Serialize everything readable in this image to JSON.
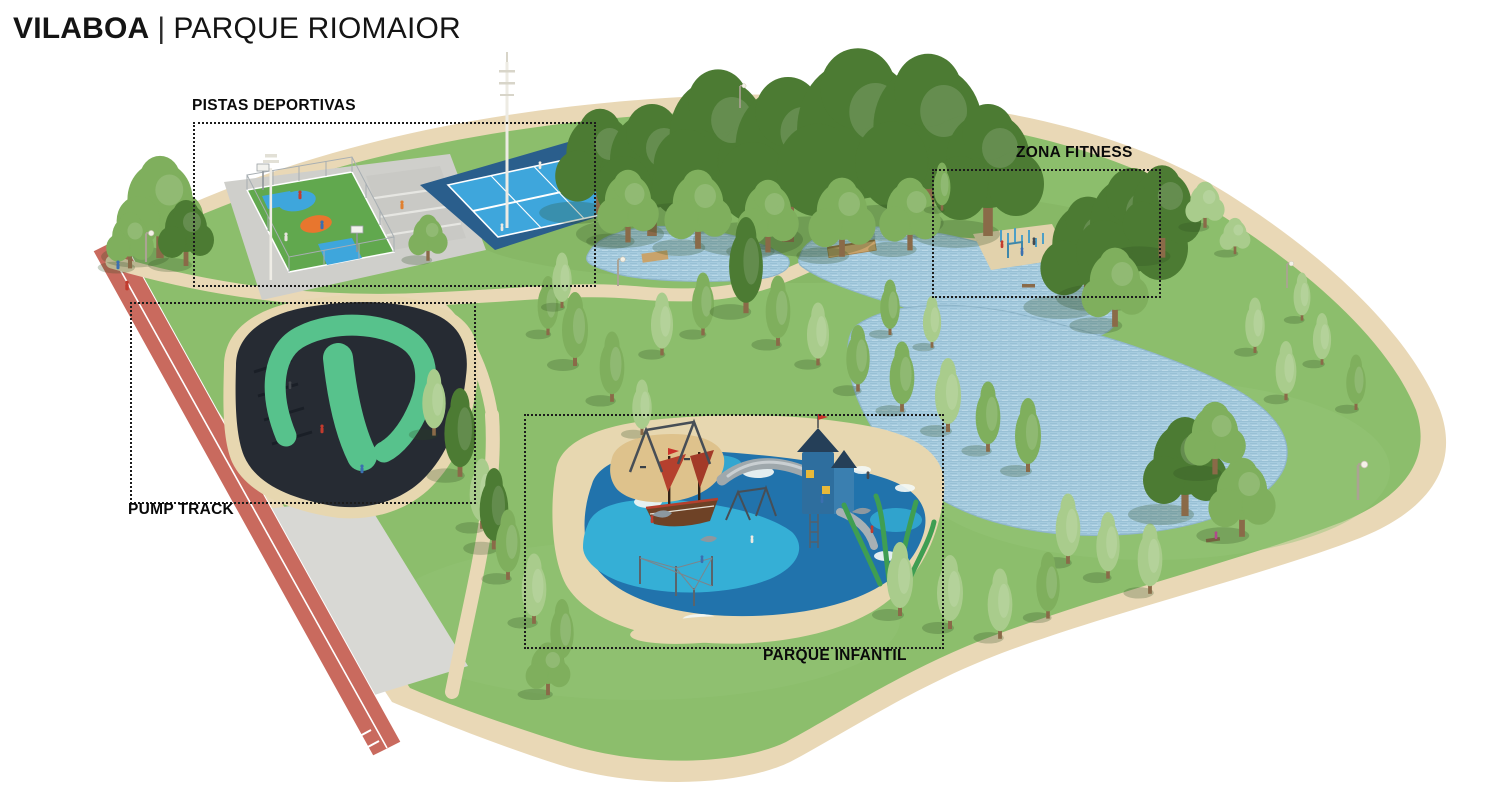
{
  "header": {
    "title_primary": "VILABOA",
    "title_separator": "|",
    "title_secondary": "PARQUE RIOMAIOR"
  },
  "zones": {
    "pistas_deportivas": {
      "label": "PISTAS DEPORTIVAS"
    },
    "zona_fitness": {
      "label": "ZONA FITNESS"
    },
    "pump_track": {
      "label": "PUMP TRACK"
    },
    "parque_infantil": {
      "label": "PARQUE INFANTIL"
    }
  },
  "colors": {
    "grass": "#8CBE6C",
    "perimeter_path": "#E9D8B6",
    "water": "#A7CCDF",
    "track_red": "#C96A5E",
    "pump_asphalt": "#262B33",
    "pump_mint": "#57C28C",
    "sand": "#E7D7B0",
    "court_turf": "#61A84E",
    "court_blue": "#3EA6DC",
    "court_dark_blue": "#2A5E8C",
    "court_orange": "#E8762E",
    "play_blue_dark": "#2173AC",
    "play_blue_light": "#35AFD6",
    "tree_dark": "#4C7B33",
    "tree_mid": "#7FAF5D",
    "tree_light": "#A9CC8C",
    "label_text": "#0A0A0A"
  }
}
